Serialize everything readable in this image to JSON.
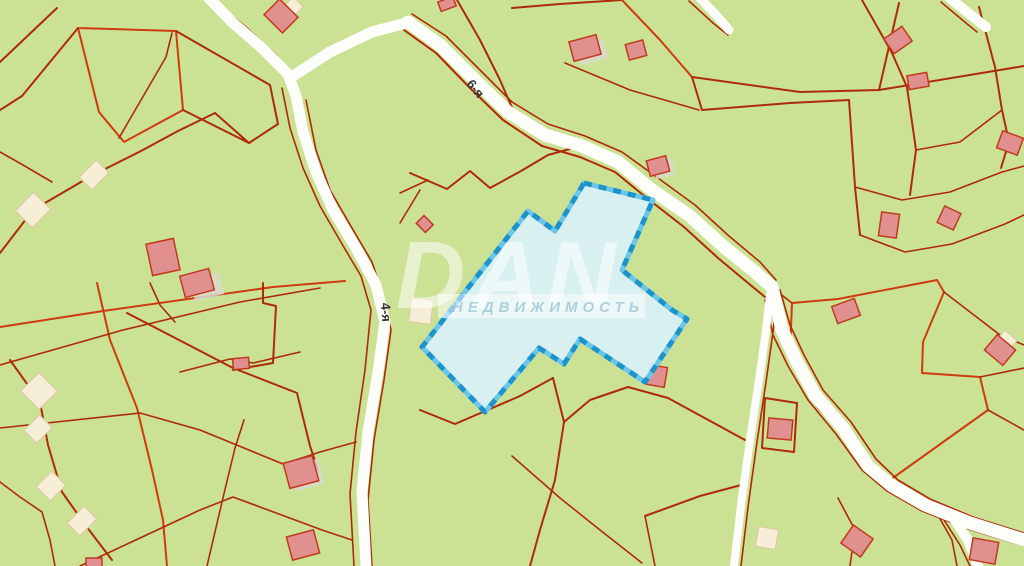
{
  "map": {
    "kind": "cadastral-parcel-map",
    "watermark": {
      "brand": "DAN",
      "tagline": "НЕДВИЖИМОСТЬ"
    },
    "road_labels": [
      {
        "text": "6-я"
      },
      {
        "text": "4-я"
      }
    ],
    "selected_parcel": {
      "points": "584,183 653,200 622,270 672,310 687,319 645,382 580,339 564,364 539,348 485,412 422,347 528,211 555,231"
    },
    "colors": {
      "background": "#cbe294",
      "parcel_line": "#ae2a08",
      "parcel_line_bright": "#cf3a10",
      "road": "#fdfdfa",
      "selected_fill": "#d8f1f8",
      "selected_border": "#1d93cc",
      "selected_border_light": "#6cc6e8",
      "building_pink": "#e19090",
      "building_pink_border": "#c03a20",
      "building_beige": "#f6eed6",
      "building_beige_border": "#ddcda6",
      "label_text": "#333333"
    }
  }
}
